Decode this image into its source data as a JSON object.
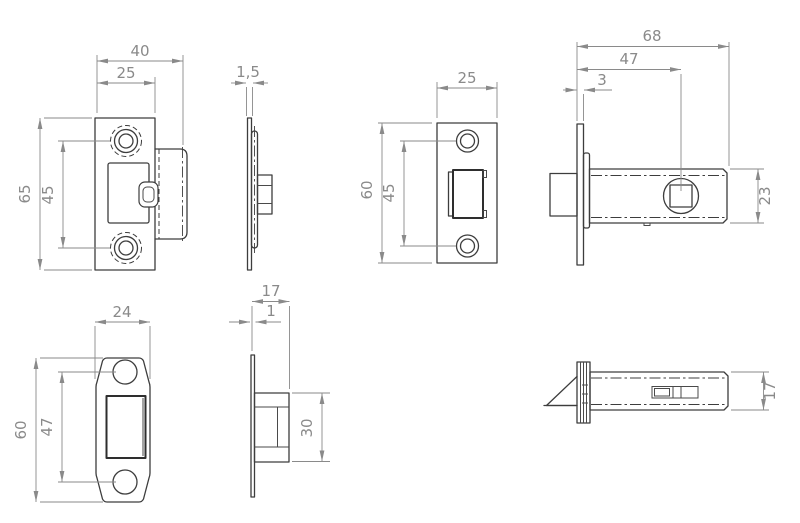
{
  "drawing": {
    "background": "#ffffff",
    "object_line_color": "#3d3d3d",
    "dimension_color": "#8a8a8a",
    "views": {
      "strike_plate_front": {
        "name": "strike plate with dust box - front view",
        "dims": {
          "overall_width": "40",
          "plate_width": "25",
          "overall_height": "65",
          "hole_spacing": "45"
        }
      },
      "strike_plate_side": {
        "name": "strike plate - side view",
        "dims": {
          "plate_thickness": "1,5"
        }
      },
      "faceplate_front": {
        "name": "latch faceplate - front view",
        "dims": {
          "width": "25",
          "height": "60",
          "hole_spacing": "45"
        }
      },
      "latch_body_side": {
        "name": "latch body - side view",
        "dims": {
          "overall_length": "68",
          "backset": "47",
          "faceplate_offset": "3",
          "body_height": "23"
        }
      },
      "box_strike_front": {
        "name": "box strike plate - front view",
        "dims": {
          "width": "24",
          "height": "60",
          "hole_spacing": "47"
        }
      },
      "box_strike_side": {
        "name": "box strike plate - side view",
        "dims": {
          "depth": "17",
          "plate_thickness": "1",
          "box_height": "30"
        }
      },
      "latch_body_top": {
        "name": "latch body - top view",
        "dims": {
          "body_width": "17"
        }
      }
    }
  }
}
